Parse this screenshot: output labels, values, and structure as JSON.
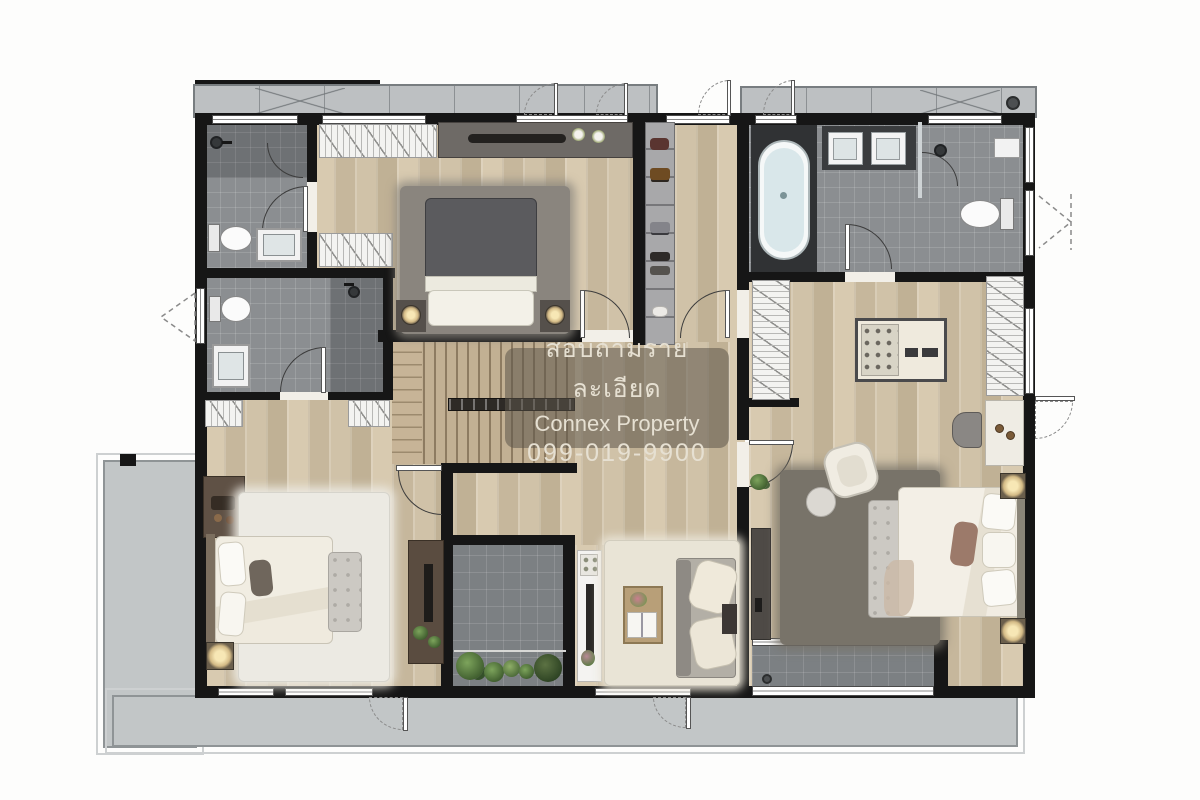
{
  "watermark": {
    "line1": "สอบถามรายละเอียด",
    "line2": "Connex Property",
    "line3": "099-019-9900"
  },
  "palette": {
    "wall": "#161616",
    "wood": "#cec0a7",
    "tile": "#8b8e91",
    "tileDark": "#6e7174",
    "voidTile": "#7c8083",
    "terrace": "#c2c6c7",
    "ledge": "#bdc0c2",
    "darkFurniture": "#55504b",
    "watermarkText": "#e6e0d2"
  }
}
